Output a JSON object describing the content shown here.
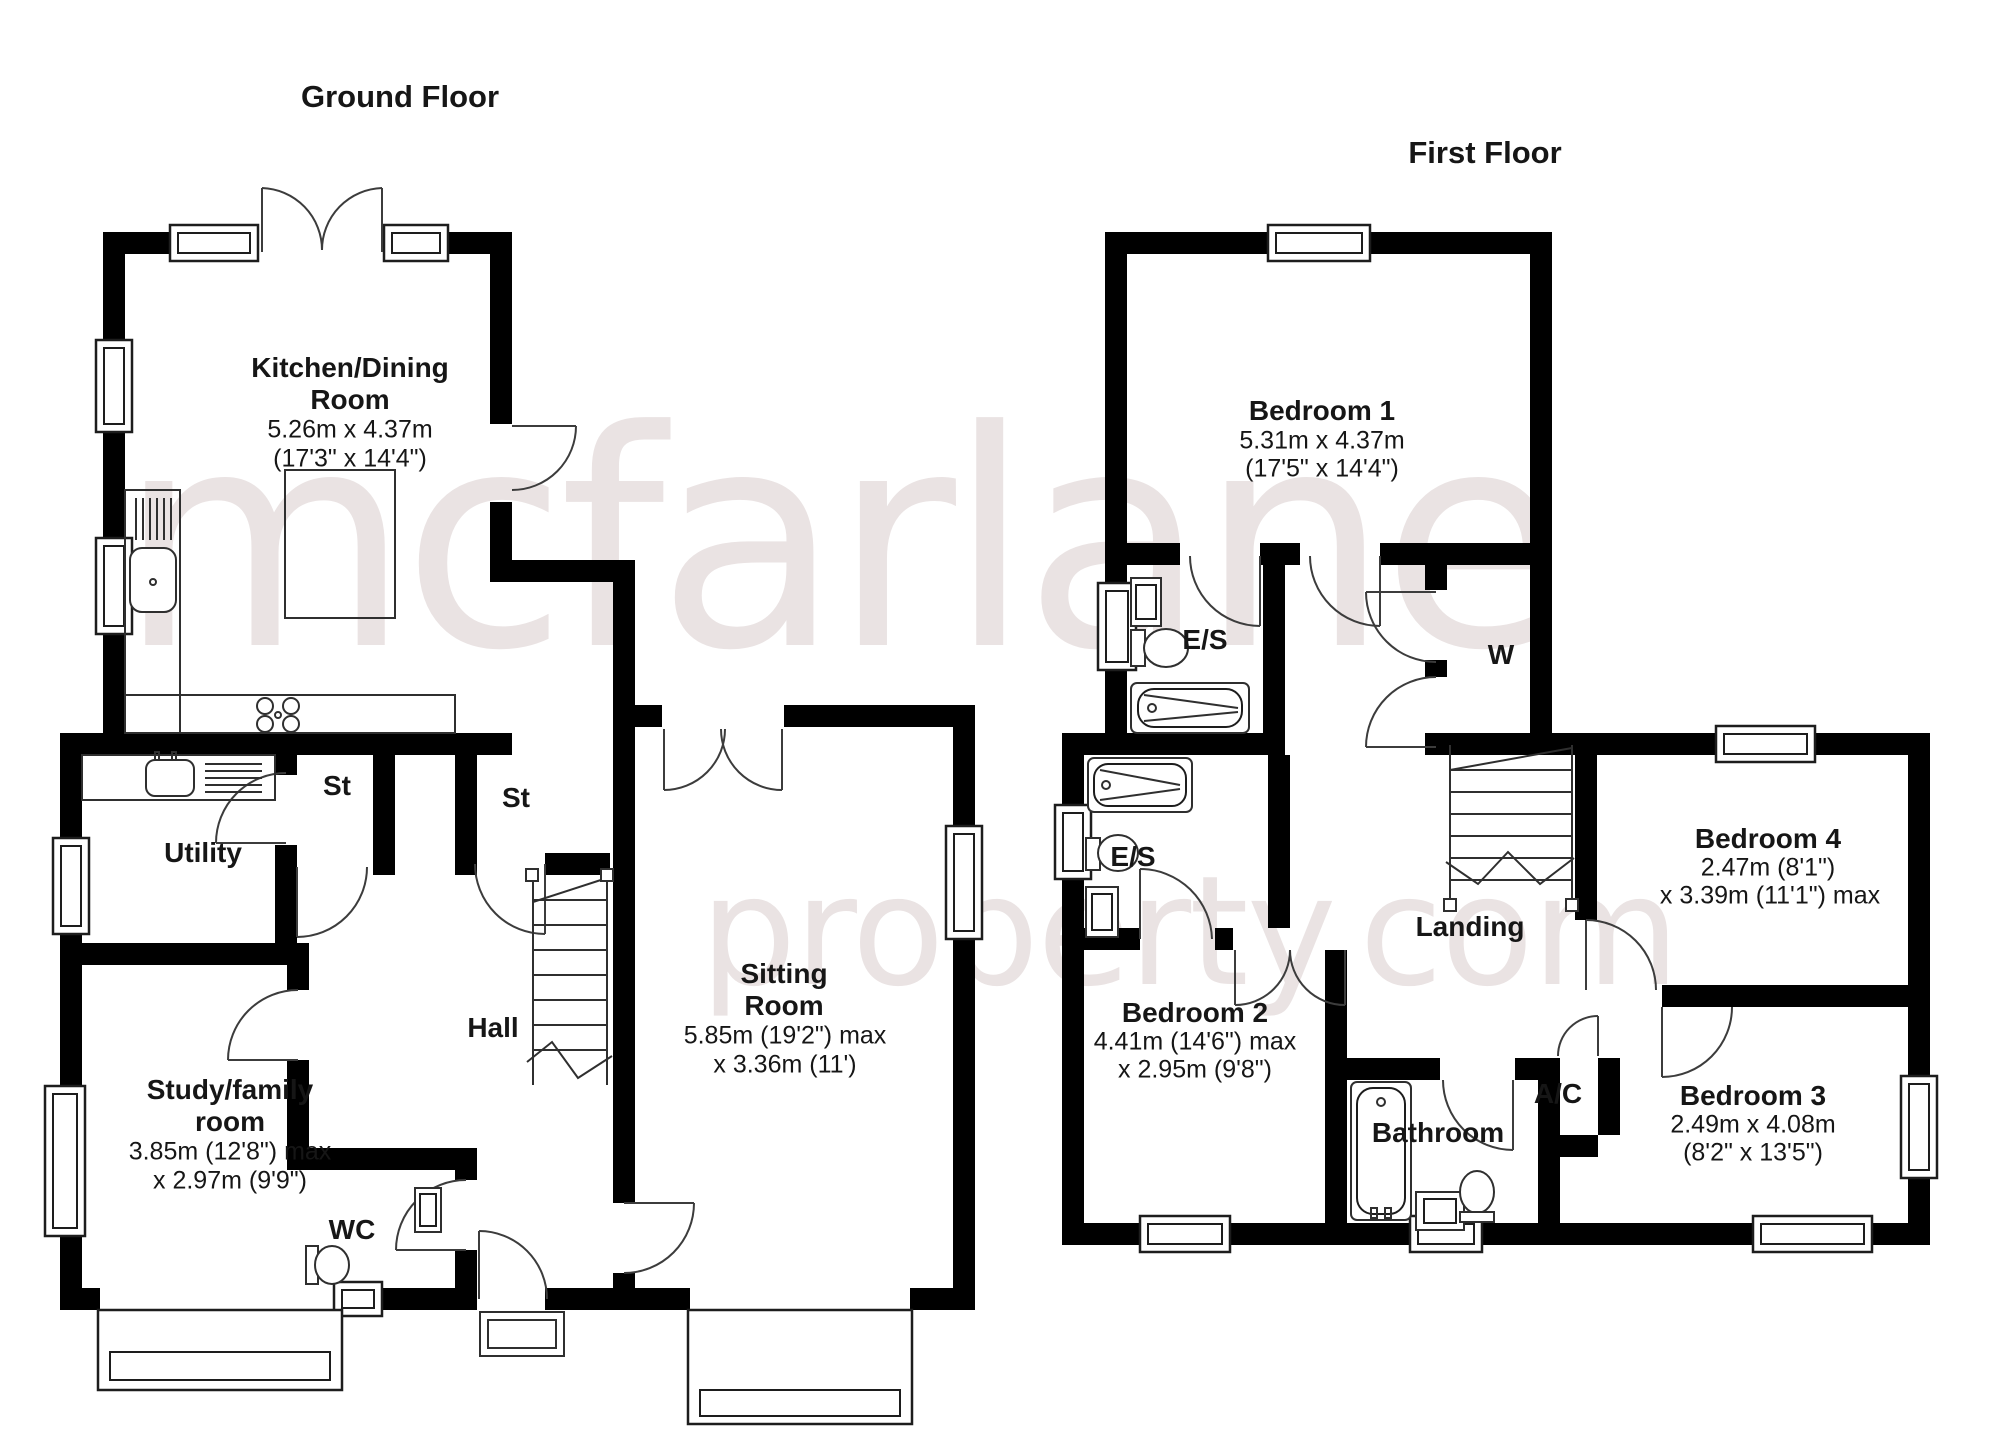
{
  "titles": {
    "ground": "Ground Floor",
    "first": "First Floor"
  },
  "watermark": {
    "line1": "mcfarlane",
    "line2": "property.com",
    "color": "#eae3e3"
  },
  "gf": {
    "kitchen": {
      "n1": "Kitchen/Dining",
      "n2": "Room",
      "d1": "5.26m x 4.37m",
      "d2": "(17'3\" x 14'4\")"
    },
    "utility": {
      "n": "Utility"
    },
    "st1": {
      "n": "St"
    },
    "st2": {
      "n": "St"
    },
    "hall": {
      "n": "Hall"
    },
    "study": {
      "n1": "Study/family",
      "n2": "room",
      "d1": "3.85m (12'8\") max",
      "d2": "x 2.97m (9'9\")"
    },
    "wc": {
      "n": "WC"
    },
    "sitting": {
      "n1": "Sitting",
      "n2": "Room",
      "d1": "5.85m (19'2\") max",
      "d2": "x 3.36m (11')"
    }
  },
  "ff": {
    "bed1": {
      "n": "Bedroom 1",
      "d1": "5.31m x 4.37m",
      "d2": "(17'5\" x 14'4\")"
    },
    "es1": {
      "n": "E/S"
    },
    "w": {
      "n": "W"
    },
    "es2": {
      "n": "E/S"
    },
    "bed2": {
      "n": "Bedroom 2",
      "d1": "4.41m (14'6\") max",
      "d2": "x 2.95m (9'8\")"
    },
    "landing": {
      "n": "Landing"
    },
    "bed4": {
      "n": "Bedroom 4",
      "d1": "2.47m (8'1\")",
      "d2": "x 3.39m (11'1\") max"
    },
    "bathroom": {
      "n": "Bathroom"
    },
    "ac": {
      "n": "A/C"
    },
    "bed3": {
      "n": "Bedroom 3",
      "d1": "2.49m x 4.08m",
      "d2": "(8'2\" x 13'5\")"
    }
  }
}
